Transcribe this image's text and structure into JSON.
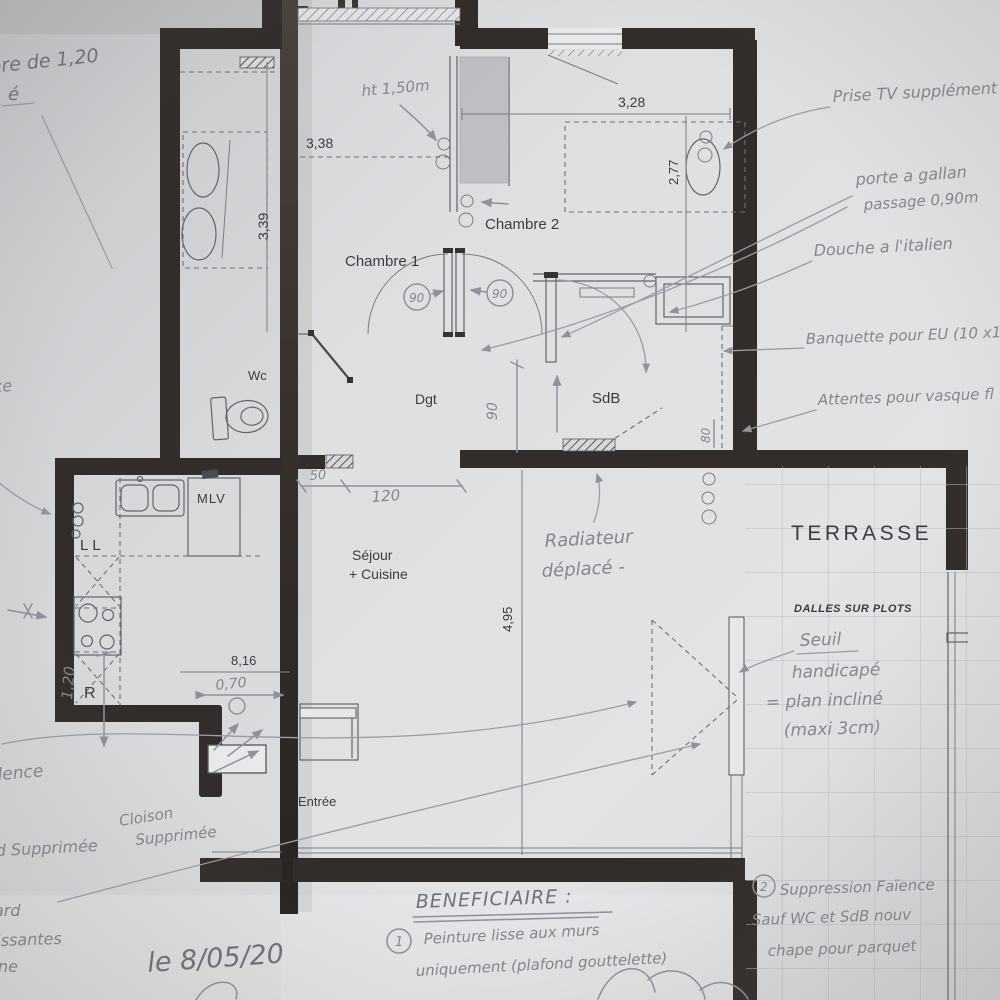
{
  "plan": {
    "rooms": {
      "chambre1": "Chambre 1",
      "chambre2": "Chambre 2",
      "wc": "Wc",
      "dgt": "Dgt",
      "sdb": "SdB",
      "sejour1": "Séjour",
      "sejour2": "+ Cuisine",
      "entree": "Entrée",
      "terrasse": "TERRASSE",
      "dalles": "DALLES SUR PLOTS"
    },
    "appliances": {
      "mlv": "MLV",
      "ll": "LL",
      "r": "R"
    },
    "dims": {
      "d339": "3,39",
      "d338": "3,38",
      "d328": "3,28",
      "d277": "2,77",
      "d816": "8,16",
      "d495": "4,95"
    },
    "hand_dims": {
      "h070": "0,70",
      "h120v": "1,20",
      "h50": "50",
      "h120": "120",
      "h90": "90",
      "h90l": "90",
      "h90r": "90",
      "h80": "80",
      "ht150": "ht 1,50m"
    },
    "annotations": {
      "frag_top1": "bre de 1,20",
      "frag_top2": "é",
      "prise_tv": "Prise TV supplément",
      "porte1": "porte a gallan",
      "porte2": "passage 0,90m",
      "douche": "Douche a l'italien",
      "banquette": "Banquette pour EU (10 x1",
      "attentes": "Attentes pour vasque fl",
      "radiateur1": "Radiateur",
      "radiateur2": "déplacé -",
      "seuil1": "Seuil",
      "seuil2": "handicapé",
      "seuil3": "= plan incliné",
      "seuil4": "(maxi 3cm)",
      "cloison1": "Cloison",
      "cloison2": "Supprimée",
      "frag_supprimee": "d Supprimée",
      "frag_dence": "dence",
      "frag_ce": "ce",
      "frag_ard": "ard",
      "frag_lissantes": "lissantes",
      "frag_ne": "ne",
      "date": "le 8/05/20",
      "beneficiaire": "BENEFICIAIRE :",
      "note1_num": "1",
      "note1a": "Peinture lisse aux murs",
      "note1b": "uniquement (plafond gouttelette)",
      "note2_num": "2",
      "note2a": "Suppression Faïence",
      "note2b": "Sauf WC et SdB nouv",
      "note2c": "chape pour parquet"
    }
  }
}
